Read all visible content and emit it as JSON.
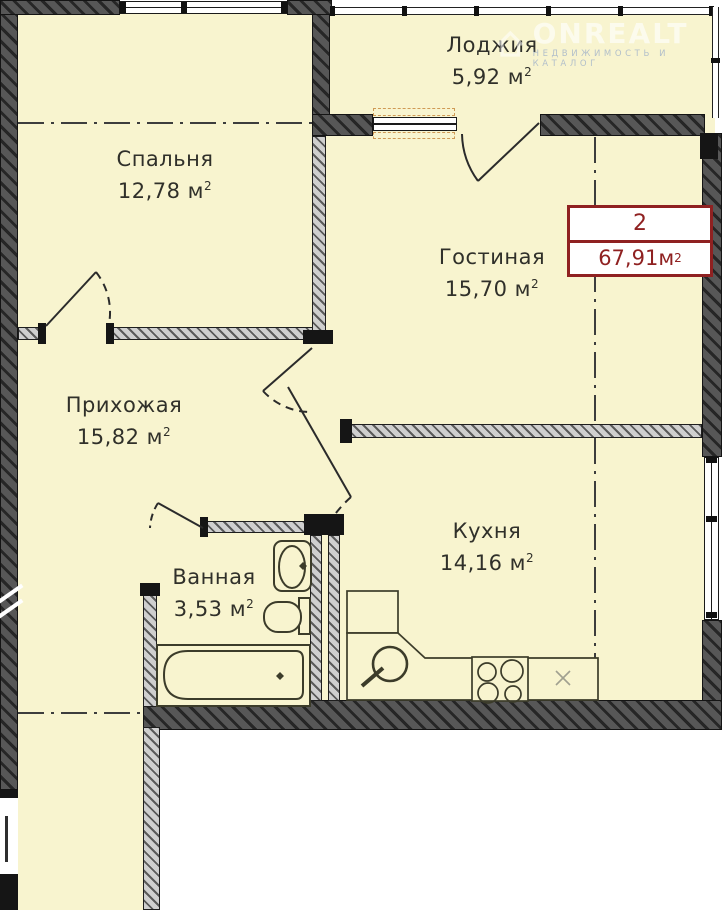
{
  "watermark": {
    "brand": "ONREALT",
    "tagline": "НЕДВИЖИМОСТЬ И КАТАЛОГ"
  },
  "badge": {
    "rooms": "2",
    "area": "67,91",
    "unit": "м",
    "sup": "2"
  },
  "units": {
    "m": "м",
    "sup": "2"
  },
  "rooms": {
    "loggia": {
      "name": "Лоджия",
      "area": "5,92"
    },
    "bedroom": {
      "name": "Спальня",
      "area": "12,78"
    },
    "living": {
      "name": "Гостиная",
      "area": "15,70"
    },
    "hallway": {
      "name": "Прихожая",
      "area": "15,82"
    },
    "bathroom": {
      "name": "Ванная",
      "area": "3,53"
    },
    "kitchen": {
      "name": "Кухня",
      "area": "14,16"
    }
  },
  "colors": {
    "floor": "#f8f4cf",
    "wall_dark": "#4c4c4c",
    "wall_light": "#cfcfcf",
    "accent_red": "#8f2121",
    "fixture_olive": "#3c3c2a"
  }
}
